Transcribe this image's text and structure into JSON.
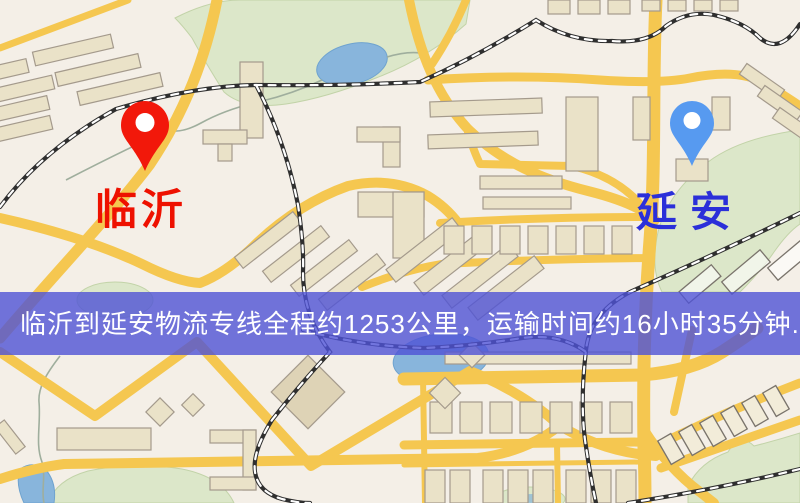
{
  "markers": {
    "origin": {
      "name": "临沂",
      "pin": "red-pin",
      "pin_color": "#f2180a",
      "label_color": "#ee1100"
    },
    "destination": {
      "name": "延安",
      "pin": "blue-pin",
      "pin_color": "#579af0",
      "label_color": "#2b2fd9"
    }
  },
  "banner": {
    "text": "临沂到延安物流专线全程约1253公里，运输时间约16小时35分钟.",
    "background": "#4f52d6",
    "text_color": "#ffffff"
  },
  "route": {
    "origin": "临沂",
    "destination": "延安",
    "distance_text": "约1253公里",
    "duration_text": "约16小时35分钟"
  },
  "palette": {
    "map_background": "#f4efe7",
    "road": "#f5c750",
    "park": "#dce7c9",
    "water": "#88b5dc",
    "building": "#eae2c8",
    "railway": "#2f2f2f"
  }
}
